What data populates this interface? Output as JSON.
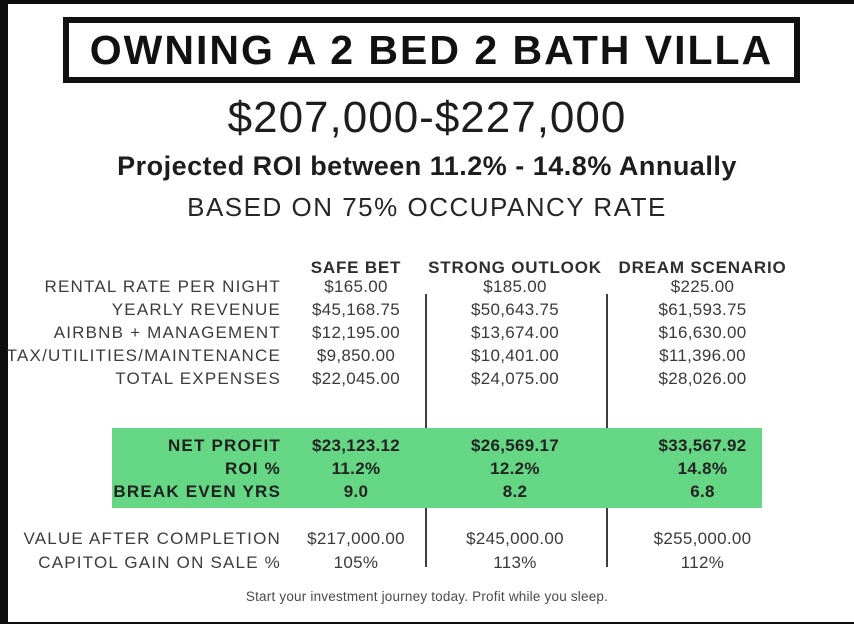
{
  "page": {
    "title": "OWNING A 2 BED 2 BATH VILLA",
    "price_range": "$207,000-$227,000",
    "roi_line": "Projected ROI between 11.2% - 14.8% Annually",
    "occupancy_line": "BASED ON 75% OCCUPANCY RATE",
    "footer": "Start your investment journey today. Profit while you sleep."
  },
  "colors": {
    "highlight_green": "#65d784",
    "frame_black": "#0e0e0e",
    "text_dark": "#3a3a3a"
  },
  "table": {
    "columns": [
      "SAFE BET",
      "STRONG OUTLOOK",
      "DREAM SCENARIO"
    ],
    "rows": [
      {
        "label": "RENTAL RATE PER NIGHT",
        "values": [
          "$165.00",
          "$185.00",
          "$225.00"
        ]
      },
      {
        "label": "YEARLY REVENUE",
        "values": [
          "$45,168.75",
          "$50,643.75",
          "$61,593.75"
        ]
      },
      {
        "label": "AIRBNB + MANAGEMENT",
        "values": [
          "$12,195.00",
          "$13,674.00",
          "$16,630.00"
        ]
      },
      {
        "label": "TAX/UTILITIES/MAINTENANCE",
        "values": [
          "$9,850.00",
          "$10,401.00",
          "$11,396.00"
        ]
      },
      {
        "label": "TOTAL EXPENSES",
        "values": [
          "$22,045.00",
          "$24,075.00",
          "$28,026.00"
        ]
      }
    ],
    "highlight_rows": [
      {
        "label": "NET PROFIT",
        "values": [
          "$23,123.12",
          "$26,569.17",
          "$33,567.92"
        ]
      },
      {
        "label": "ROI %",
        "values": [
          "11.2%",
          "12.2%",
          "14.8%"
        ]
      },
      {
        "label": "BREAK EVEN YRS",
        "values": [
          "9.0",
          "8.2",
          "6.8"
        ]
      }
    ],
    "bottom_rows": [
      {
        "label": "VALUE AFTER COMPLETION",
        "values": [
          "$217,000.00",
          "$245,000.00",
          "$255,000.00"
        ]
      },
      {
        "label": "CAPITOL GAIN ON SALE %",
        "values": [
          "105%",
          "113%",
          "112%"
        ]
      }
    ]
  }
}
